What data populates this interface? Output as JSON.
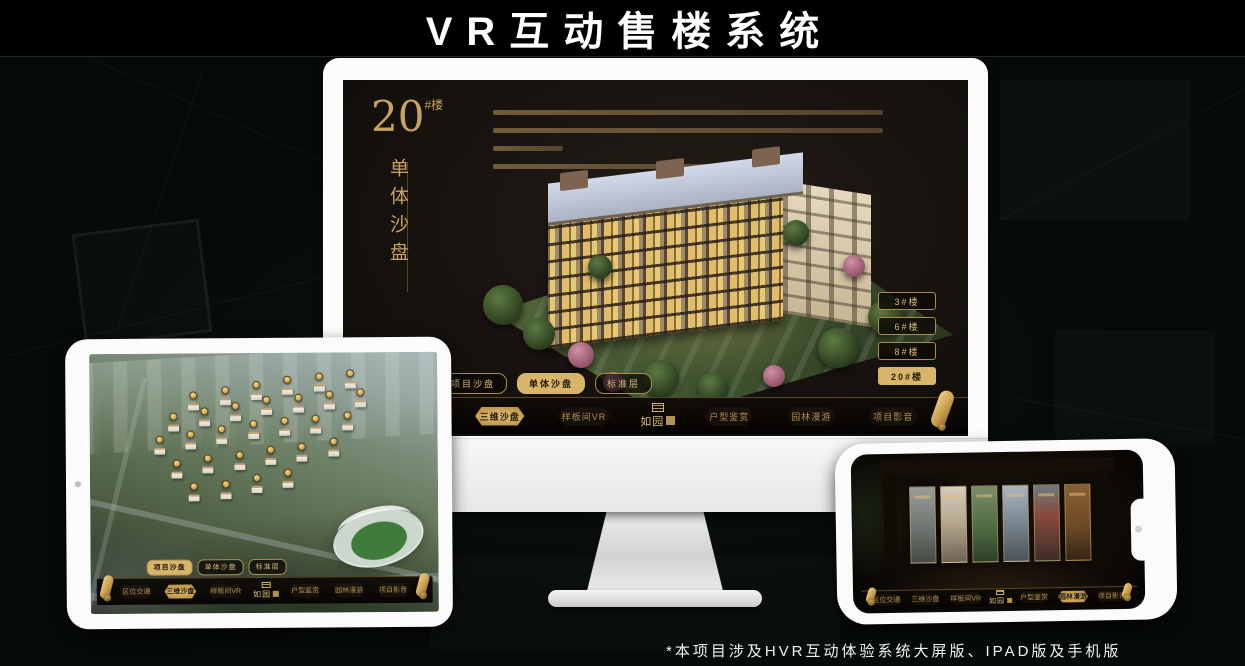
{
  "page": {
    "title": "VR互动售楼系统",
    "footnote": "*本项目涉及HVR互动体验系统大屏版、IPAD版及手机版"
  },
  "brand": {
    "logo": "如园"
  },
  "colors": {
    "gold": "#c9a35f",
    "gold_active": "#d9b56a",
    "screen_bg": "#15110d",
    "nav_bg": "#0a0805"
  },
  "monitor": {
    "hero": {
      "number": "20",
      "suffix": "#楼",
      "subtitle": "单体沙盘"
    },
    "floor_buttons": [
      {
        "label": "3#楼"
      },
      {
        "label": "6#楼"
      },
      {
        "label": "8#楼"
      },
      {
        "label": "20#楼",
        "active": true
      }
    ],
    "tabs": [
      {
        "label": "项目沙盘"
      },
      {
        "label": "单体沙盘",
        "active": true
      },
      {
        "label": "标准层"
      }
    ],
    "nav_left": [
      {
        "label": "区位交通"
      },
      {
        "label": "三维沙盘",
        "active": true
      },
      {
        "label": "样板间VR"
      }
    ],
    "nav_right": [
      {
        "label": "户型鉴赏"
      },
      {
        "label": "园林漫游"
      },
      {
        "label": "项目影音"
      }
    ]
  },
  "ipad": {
    "tabs": [
      {
        "label": "项目沙盘",
        "active": true
      },
      {
        "label": "单体沙盘"
      },
      {
        "label": "标准层"
      }
    ],
    "nav_left": [
      {
        "label": "区位交通"
      },
      {
        "label": "三维沙盘",
        "active": true
      },
      {
        "label": "样板间VR"
      }
    ],
    "nav_right": [
      {
        "label": "户型鉴赏"
      },
      {
        "label": "园林漫游"
      },
      {
        "label": "项目影音"
      }
    ],
    "markers": [
      {
        "x": 30,
        "y": 17
      },
      {
        "x": 39,
        "y": 15
      },
      {
        "x": 48,
        "y": 13
      },
      {
        "x": 57,
        "y": 11
      },
      {
        "x": 66,
        "y": 10
      },
      {
        "x": 75,
        "y": 9
      },
      {
        "x": 24,
        "y": 25
      },
      {
        "x": 33,
        "y": 23
      },
      {
        "x": 42,
        "y": 21
      },
      {
        "x": 51,
        "y": 19
      },
      {
        "x": 60,
        "y": 18
      },
      {
        "x": 69,
        "y": 17
      },
      {
        "x": 78,
        "y": 16
      },
      {
        "x": 20,
        "y": 34
      },
      {
        "x": 29,
        "y": 32
      },
      {
        "x": 38,
        "y": 30
      },
      {
        "x": 47,
        "y": 28
      },
      {
        "x": 56,
        "y": 27
      },
      {
        "x": 65,
        "y": 26
      },
      {
        "x": 74,
        "y": 25
      },
      {
        "x": 25,
        "y": 43
      },
      {
        "x": 34,
        "y": 41
      },
      {
        "x": 43,
        "y": 40
      },
      {
        "x": 52,
        "y": 38
      },
      {
        "x": 61,
        "y": 37
      },
      {
        "x": 70,
        "y": 35
      },
      {
        "x": 30,
        "y": 52
      },
      {
        "x": 39,
        "y": 51
      },
      {
        "x": 48,
        "y": 49
      },
      {
        "x": 57,
        "y": 47
      }
    ]
  },
  "phone": {
    "nav_left": [
      {
        "label": "区位交通"
      },
      {
        "label": "三维沙盘"
      },
      {
        "label": "样板间VR"
      }
    ],
    "nav_right": [
      {
        "label": "户型鉴赏"
      },
      {
        "label": "园林漫游",
        "active": true
      },
      {
        "label": "项目影音"
      }
    ],
    "panels": [
      {
        "style": {
          "background": "linear-gradient(180deg,#9a9d98,#6f7470 55%,#474a45)"
        }
      },
      {
        "style": {
          "background": "linear-gradient(180deg,#d6cdbb,#b3a58c 50%,#6e6352)"
        }
      },
      {
        "style": {
          "background": "linear-gradient(180deg,#7b8d6a,#4f6b44 55%,#2e3f28)"
        }
      },
      {
        "style": {
          "background": "linear-gradient(180deg,#aab6bf,#7d8b96 45%,#4a5258)"
        }
      },
      {
        "style": {
          "background": "linear-gradient(180deg,#6e7a80,#8a4a3a 40%,#3a2e28)"
        }
      },
      {
        "style": {
          "background": "linear-gradient(180deg,#8a5f33,#6e4a26 55%,#352414)"
        }
      }
    ]
  }
}
